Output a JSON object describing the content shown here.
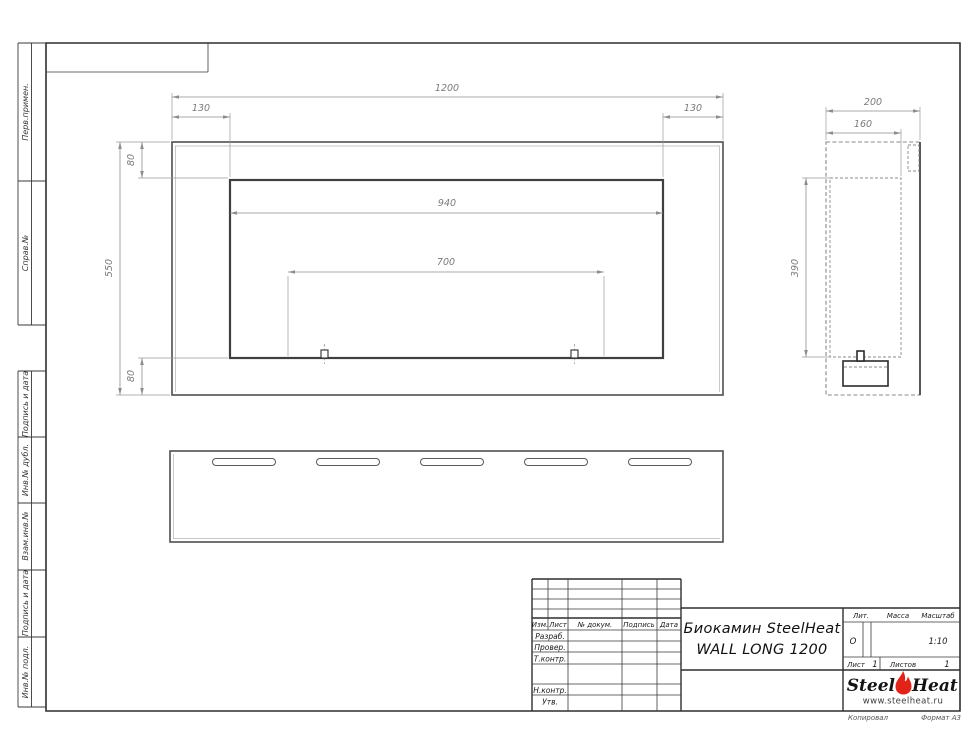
{
  "sheet": {
    "margin_labels": {
      "top": [
        "Перв.примен.",
        "Справ.№"
      ],
      "bottom": [
        "Подпись и дата",
        "Инв.№ дубл.",
        "Взам.инв.№",
        "Подпись и дата",
        "Инв.№ подл."
      ]
    },
    "footer_left": "Копировал",
    "footer_right": "Формат А3"
  },
  "dimensions": [
    {
      "value": "1200",
      "orient": "h",
      "x1": 172,
      "x2": 723,
      "y": 97,
      "tx": 447,
      "ty": 91
    },
    {
      "value": "130",
      "orient": "h",
      "x1": 172,
      "x2": 230,
      "y": 117,
      "tx": 201,
      "ty": 111
    },
    {
      "value": "130",
      "orient": "h",
      "x1": 663,
      "x2": 723,
      "y": 117,
      "tx": 693,
      "ty": 111
    },
    {
      "value": "940",
      "orient": "h",
      "x1": 230,
      "x2": 663,
      "y": 213,
      "tx": 447,
      "ty": 206
    },
    {
      "value": "700",
      "orient": "h",
      "x1": 288,
      "x2": 604,
      "y": 272,
      "tx": 446,
      "ty": 265
    },
    {
      "value": "80",
      "orient": "v",
      "x": 142,
      "y1": 142,
      "y2": 178,
      "tx": 134,
      "ty": 160
    },
    {
      "value": "550",
      "orient": "v",
      "x": 120,
      "y1": 142,
      "y2": 395,
      "tx": 112,
      "ty": 268
    },
    {
      "value": "80",
      "orient": "v",
      "x": 142,
      "y1": 358,
      "y2": 395,
      "tx": 134,
      "ty": 376
    },
    {
      "value": "200",
      "orient": "h",
      "x1": 826,
      "x2": 920,
      "y": 111,
      "tx": 873,
      "ty": 105
    },
    {
      "value": "160",
      "orient": "h",
      "x1": 826,
      "x2": 901,
      "y": 133,
      "tx": 863,
      "ty": 127
    },
    {
      "value": "390",
      "orient": "v",
      "x": 806,
      "y1": 178,
      "y2": 357,
      "tx": 798,
      "ty": 268
    }
  ],
  "title_block": {
    "header_cols": [
      "Изм.",
      "Лист",
      "№ докум.",
      "Подпись",
      "Дата"
    ],
    "row_labels": [
      "Разраб.",
      "Провер.",
      "Т.контр.",
      "Н.контр.",
      "Утв."
    ],
    "product_title_line1": "Биокамин SteelHeat",
    "product_title_line2": "WALL LONG 1200",
    "lit_label": "Лит.",
    "lit_value": "О",
    "mass_label": "Масса",
    "scale_label": "Масштаб",
    "scale_value": "1:10",
    "sheet_label": "Лист",
    "sheet_number": "1",
    "sheets_label": "Листов",
    "sheets_total": "1",
    "logo": {
      "part1": "Steel",
      "part2": "Heat",
      "website": "www.steelheat.ru"
    }
  }
}
